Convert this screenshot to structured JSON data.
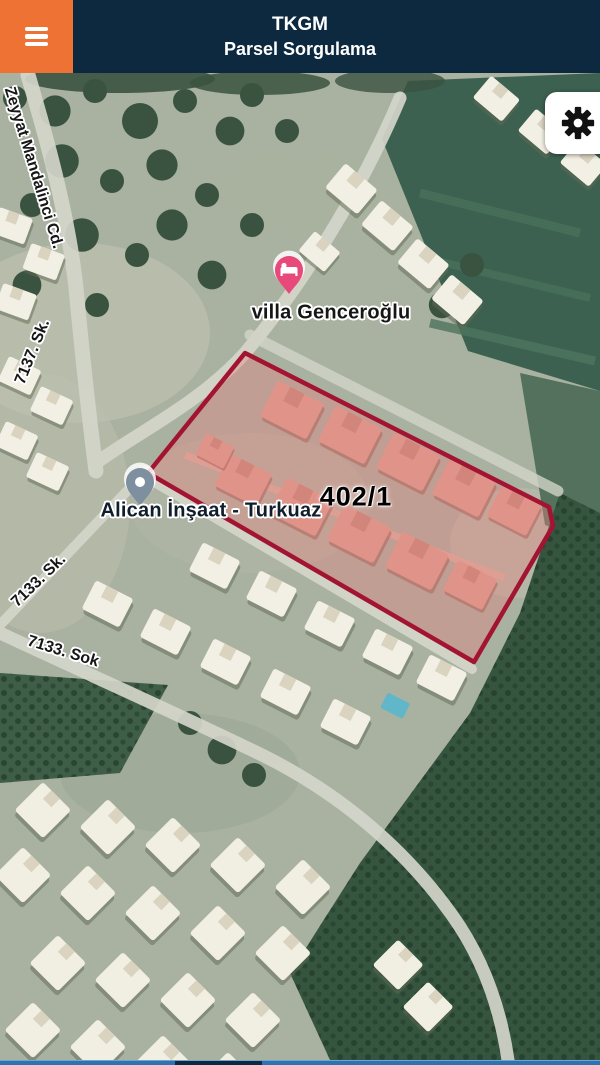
{
  "header": {
    "title": "TKGM",
    "subtitle": "Parsel Sorgulama"
  },
  "map": {
    "parcel": {
      "label": "402/1"
    },
    "pois": [
      {
        "id": "villa-genceroglu",
        "label": "villa Genceroğlu"
      },
      {
        "id": "alican-insaat",
        "label": "Alican İnşaat - Turkuaz"
      }
    ],
    "streets": [
      {
        "id": "zeyyat-mandalinci",
        "label": "Zeyyat Mandalinci Cd."
      },
      {
        "id": "sk-7137",
        "label": "7137. Sk."
      },
      {
        "id": "sk-7133",
        "label": "7133. Sk."
      },
      {
        "id": "sok-7133",
        "label": "7133. Sok"
      }
    ]
  },
  "colors": {
    "header_bg": "#0d2940",
    "menu_bg": "#ee7233",
    "parcel_stroke": "#a21431",
    "parcel_fill": "rgba(231,130,125,0.38)",
    "villa_pin": "#e8497b",
    "alican_pin": "#7e90a0",
    "footer_bar": "#2e72b0",
    "footer_segment": "#0d2940"
  }
}
